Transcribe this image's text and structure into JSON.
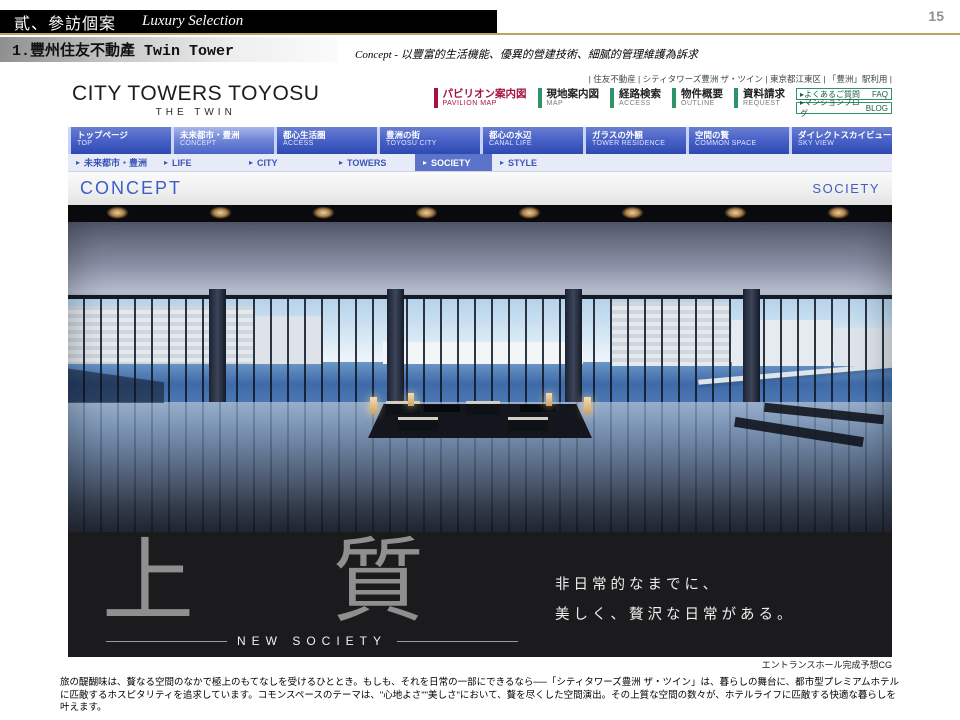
{
  "slide": {
    "page_number": "15",
    "header": {
      "title_zh": "貳、參訪個案",
      "title_en": "Luxury Selection"
    },
    "subheader": "1.豐州住友不動產 Twin Tower",
    "concept_note": "Concept - 以豐富的生活機能、優異的營建技術、細膩的管理維護為訴求",
    "body_text": "旅の醍醐味は、贅なる空間のなかで極上のもてなしを受けるひととき。もしも、それを日常の一部にできるなら──「シティタワーズ豊洲 ザ・ツイン」は、暮らしの舞台に、都市型プレミアムホテルに匹敵するホスピタリティを追求しています。コモンスペースのテーマは、\"心地よさ\"\"美しさ\"において、贅を尽くした空間演出。その上質な空間の数々が、ホテルライフに匹敵する快適な暮らしを叶えます。"
  },
  "icons": {
    "arrow": "▸"
  },
  "colors": {
    "accent_red": "#a6133f",
    "accent_green": "#2e9467",
    "nav_blue": "#4a63c8",
    "link_blue": "#3a55b8",
    "gold": "#b9a65c",
    "band_black": "#1b1b1d"
  },
  "site": {
    "logo": {
      "line1": "CITY TOWERS TOYOSU",
      "line2": "THE TWIN"
    },
    "tagline": "| 住友不動産 | シティタワーズ豊洲 ザ・ツイン | 東京都江東区 | 「豊洲」駅利用 |",
    "utility_nav": [
      {
        "jp": "パビリオン案内図",
        "en": "PAVILION MAP",
        "accent": "#a6133f"
      },
      {
        "jp": "現地案内図",
        "en": "MAP",
        "accent": "#2e9467"
      },
      {
        "jp": "経路検索",
        "en": "ACCESS",
        "accent": "#2e9467"
      },
      {
        "jp": "物件概要",
        "en": "OUTLINE",
        "accent": "#2e9467"
      },
      {
        "jp": "資料請求",
        "en": "REQUEST",
        "accent": "#2e9467"
      }
    ],
    "link_boxes": [
      {
        "label": "よくあるご質問",
        "tag": "FAQ"
      },
      {
        "label": "マンションブログ",
        "tag": "BLOG"
      }
    ],
    "main_nav": [
      {
        "jp": "トップページ",
        "en": "TOP"
      },
      {
        "jp": "未来都市・豊洲",
        "en": "CONCEPT"
      },
      {
        "jp": "都心生活圏",
        "en": "ACCESS"
      },
      {
        "jp": "豊洲の街",
        "en": "TOYOSU CITY"
      },
      {
        "jp": "都心の水辺",
        "en": "CANAL LIFE"
      },
      {
        "jp": "ガラスの外観",
        "en": "TOWER RESIDENCE"
      },
      {
        "jp": "空間の贅",
        "en": "COMMON SPACE"
      },
      {
        "jp": "ダイレクトスカイビュー",
        "en": "SKY VIEW"
      }
    ],
    "sub_nav": [
      {
        "label": "未来都市・豊洲"
      },
      {
        "label": "LIFE"
      },
      {
        "label": "CITY"
      },
      {
        "label": "TOWERS"
      },
      {
        "label": "SOCIETY"
      },
      {
        "label": "STYLE"
      }
    ],
    "breadcrumb": {
      "left": "CONCEPT",
      "right": "SOCIETY"
    },
    "hero": {
      "kanji_1": "上",
      "kanji_2": "質",
      "sub_title": "NEW SOCIETY",
      "copy_line1": "非日常的なまでに、",
      "copy_line2": "美しく、贅沢な日常がある。",
      "caption": "エントランスホール完成予想CG"
    }
  }
}
